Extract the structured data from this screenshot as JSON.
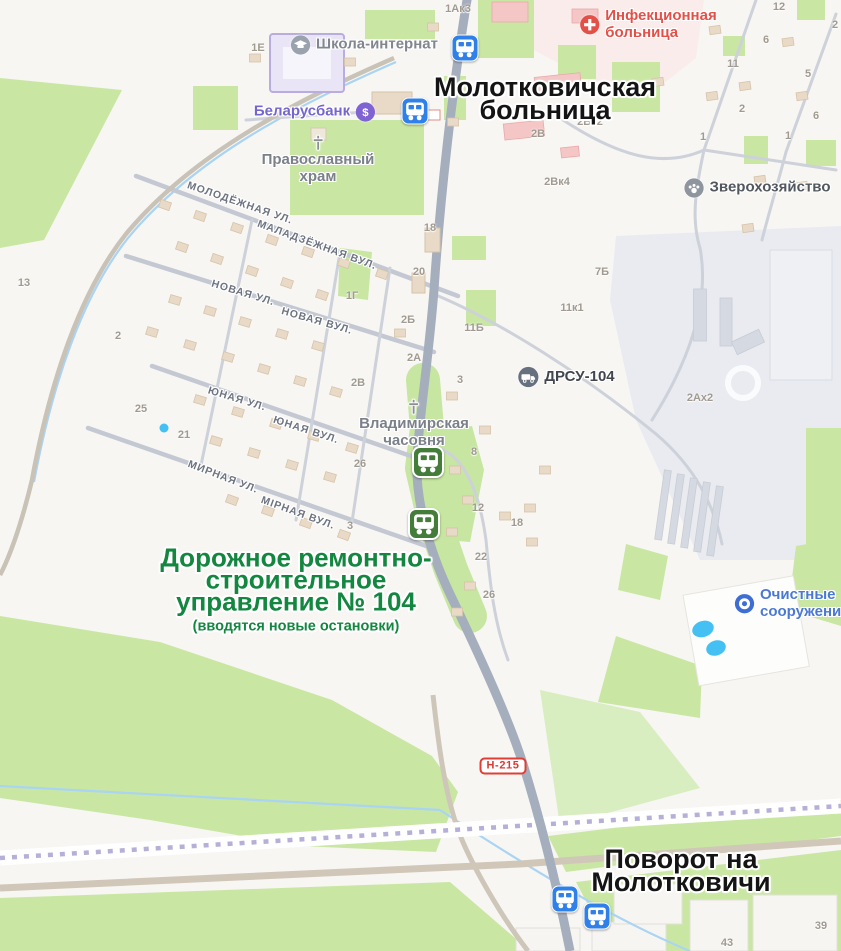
{
  "map": {
    "annotations": [
      {
        "id": "hospital-callout",
        "lines": [
          "Молотковичская",
          "больница"
        ],
        "subline": "",
        "x": 545,
        "y": 99,
        "font_size": 27,
        "sub_size": 0,
        "color": "#141414"
      },
      {
        "id": "drsu-callout",
        "lines": [
          "Дорожное ремонтно-",
          "строительное",
          "управление № 104"
        ],
        "subline": "(вводятся новые остановки)",
        "x": 296,
        "y": 592,
        "font_size": 26,
        "sub_size": 14.5,
        "color": "#13863f"
      },
      {
        "id": "turn-callout",
        "lines": [
          "Поворот на",
          "Молотковичи"
        ],
        "subline": "",
        "x": 681,
        "y": 871,
        "font_size": 27,
        "sub_size": 0,
        "color": "#141414"
      }
    ],
    "pois": [
      {
        "id": "boarding-school",
        "icon": "school",
        "layout": "icon-left",
        "x": 364,
        "y": 45,
        "lines": [
          "Школа-интернат"
        ],
        "color": "#82878f",
        "icon_color": "#9aa2ae"
      },
      {
        "id": "belarusbank",
        "icon": "bank",
        "layout": "icon-right",
        "x": 315,
        "y": 112,
        "lines": [
          "Беларусбанк"
        ],
        "color": "#7466cd",
        "icon_color": "#7f63d2"
      },
      {
        "id": "infectious-hospital",
        "icon": "medical-cross",
        "layout": "icon-left",
        "x": 648,
        "y": 25,
        "lines": [
          "Инфекционная",
          "больница"
        ],
        "color": "#e25048",
        "icon_color": "#e25048"
      },
      {
        "id": "orthodox-church",
        "icon": "church-cross",
        "layout": "icon-top",
        "x": 318,
        "y": 160,
        "lines": [
          "Православный",
          "храм"
        ],
        "color": "#7b8089",
        "icon_color": "#8e8e95"
      },
      {
        "id": "vladimir-chapel",
        "icon": "church-cross",
        "layout": "icon-top",
        "x": 414,
        "y": 424,
        "lines": [
          "Владимирская",
          "часовня"
        ],
        "color": "#7b8089",
        "icon_color": "#8e8e95"
      },
      {
        "id": "drsu-104",
        "icon": "truck",
        "layout": "icon-left",
        "x": 566,
        "y": 377,
        "lines": [
          "ДРСУ-104"
        ],
        "color": "#42474f",
        "icon_color": "#67707e"
      },
      {
        "id": "fur-farm",
        "icon": "paw",
        "layout": "icon-left",
        "x": 757,
        "y": 188,
        "lines": [
          "Зверохозяйство"
        ],
        "color": "#52575f",
        "icon_color": "#8f959f"
      },
      {
        "id": "treatment-facilities",
        "icon": "ring",
        "layout": "icon-left",
        "x": 792,
        "y": 604,
        "lines": [
          "Очистные",
          "сооружения"
        ],
        "color": "#4b79d2",
        "icon_color": "#3e6ed4"
      }
    ],
    "street_labels": [
      {
        "text": "МОЛОДЁЖНАЯ УЛ.",
        "x": 240,
        "y": 203,
        "rotation": 19
      },
      {
        "text": "МАЛАДЗЁЖНАЯ ВУЛ.",
        "x": 317,
        "y": 245,
        "rotation": 20
      },
      {
        "text": "НОВАЯ УЛ.",
        "x": 243,
        "y": 293,
        "rotation": 17
      },
      {
        "text": "НОВАЯ ВУЛ.",
        "x": 317,
        "y": 321,
        "rotation": 16
      },
      {
        "text": "ЮНАЯ УЛ.",
        "x": 237,
        "y": 399,
        "rotation": 17
      },
      {
        "text": "ЮНАЯ ВУЛ.",
        "x": 306,
        "y": 430,
        "rotation": 18
      },
      {
        "text": "МИРНАЯ УЛ.",
        "x": 223,
        "y": 477,
        "rotation": 21
      },
      {
        "text": "МІРНАЯ ВУЛ.",
        "x": 298,
        "y": 513,
        "rotation": 20
      }
    ],
    "building_numbers": [
      {
        "text": "1Ак3",
        "x": 458,
        "y": 9
      },
      {
        "text": "1Е",
        "x": 258,
        "y": 48
      },
      {
        "text": "12",
        "x": 779,
        "y": 7
      },
      {
        "text": "2",
        "x": 835,
        "y": 25
      },
      {
        "text": "6",
        "x": 766,
        "y": 40
      },
      {
        "text": "11",
        "x": 733,
        "y": 64
      },
      {
        "text": "5",
        "x": 808,
        "y": 74
      },
      {
        "text": "2",
        "x": 742,
        "y": 109
      },
      {
        "text": "6",
        "x": 816,
        "y": 116
      },
      {
        "text": "1",
        "x": 703,
        "y": 137
      },
      {
        "text": "1",
        "x": 788,
        "y": 136
      },
      {
        "text": "2В",
        "x": 538,
        "y": 134
      },
      {
        "text": "2Вк2",
        "x": 590,
        "y": 122
      },
      {
        "text": "2Вк4",
        "x": 557,
        "y": 182
      },
      {
        "text": "7Б",
        "x": 602,
        "y": 272
      },
      {
        "text": "11к1",
        "x": 572,
        "y": 308
      },
      {
        "text": "18",
        "x": 430,
        "y": 228
      },
      {
        "text": "20",
        "x": 419,
        "y": 272
      },
      {
        "text": "1Г",
        "x": 352,
        "y": 296
      },
      {
        "text": "2Б",
        "x": 408,
        "y": 320
      },
      {
        "text": "11Б",
        "x": 474,
        "y": 328
      },
      {
        "text": "2А",
        "x": 414,
        "y": 358
      },
      {
        "text": "3",
        "x": 460,
        "y": 380
      },
      {
        "text": "2В",
        "x": 358,
        "y": 383
      },
      {
        "text": "2Ах2",
        "x": 700,
        "y": 398
      },
      {
        "text": "13",
        "x": 24,
        "y": 283
      },
      {
        "text": "2",
        "x": 118,
        "y": 336
      },
      {
        "text": "25",
        "x": 141,
        "y": 409
      },
      {
        "text": "21",
        "x": 184,
        "y": 435
      },
      {
        "text": "26",
        "x": 360,
        "y": 464
      },
      {
        "text": "8",
        "x": 474,
        "y": 452
      },
      {
        "text": "12",
        "x": 478,
        "y": 508
      },
      {
        "text": "18",
        "x": 517,
        "y": 523
      },
      {
        "text": "3",
        "x": 350,
        "y": 526
      },
      {
        "text": "22",
        "x": 481,
        "y": 557
      },
      {
        "text": "26",
        "x": 489,
        "y": 595
      },
      {
        "text": "39",
        "x": 821,
        "y": 926
      },
      {
        "text": "43",
        "x": 727,
        "y": 943
      }
    ],
    "bus_stops": [
      {
        "x": 465,
        "y": 48,
        "variant": "blue"
      },
      {
        "x": 415,
        "y": 111,
        "variant": "blue"
      },
      {
        "x": 428,
        "y": 462,
        "variant": "green"
      },
      {
        "x": 424,
        "y": 524,
        "variant": "green"
      },
      {
        "x": 565,
        "y": 899,
        "variant": "blue"
      },
      {
        "x": 597,
        "y": 916,
        "variant": "blue"
      }
    ],
    "road_badge": {
      "text": "Н-215",
      "x": 503,
      "y": 766
    },
    "colors": {
      "bus_blue": "#2f80e8",
      "bus_green": "#447c3a",
      "annotation_green": "#13863f",
      "annotation_black": "#141414",
      "road_badge_red": "#e23e36",
      "map_green": "#c9e7a3",
      "water_blue": "#45c0f2"
    }
  }
}
